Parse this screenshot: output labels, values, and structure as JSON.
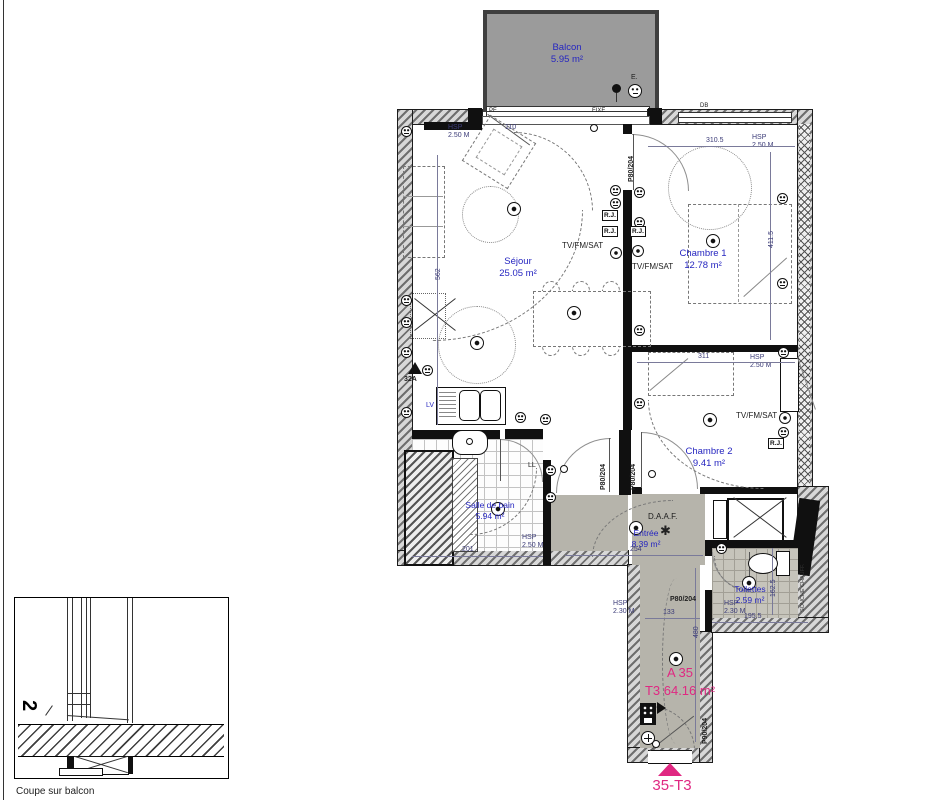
{
  "unit": {
    "code": "A 35",
    "type_area": "T3 64.16 m²",
    "entry_tag": "35-T3"
  },
  "balcony": {
    "name": "Balcon",
    "area": "5.95 m²"
  },
  "rooms": {
    "sejour": {
      "name": "Séjour",
      "area": "25.05 m²"
    },
    "chambre1": {
      "name": "Chambre 1",
      "area": "12.78 m²"
    },
    "chambre2": {
      "name": "Chambre 2",
      "area": "9.41 m²"
    },
    "sdb": {
      "name": "Salle de bain",
      "area": "5.94 m²"
    },
    "entree": {
      "name": "Entrée",
      "area": "8.39 m²"
    },
    "wc": {
      "name": "Toilettes",
      "area": "2.59 m²"
    }
  },
  "heights": {
    "hsp": "HSP",
    "h250": "2.50 M",
    "h230": "2.30 M"
  },
  "dims": {
    "d3105": "310.5",
    "d4115": "411.5",
    "d311": "311",
    "d562": "562",
    "d254": "254",
    "d133": "133",
    "d480": "480",
    "d1955": "195.5",
    "d1625": "162.5",
    "d201": "201",
    "d110": "110"
  },
  "doors": {
    "p80": "P80/204",
    "p90": "P90/204"
  },
  "windows": {
    "pf": "PF",
    "fixe": "FIXE",
    "db": "DB"
  },
  "electric": {
    "tv": "TV/FM/SAT",
    "rj": "R.J.",
    "daaf": "D.A.A.F.",
    "lv": "LV",
    "ll": "LL",
    "amp": "32A",
    "e": "E."
  },
  "shaft": {
    "line1": "SOUCHE",
    "line2": "CHAUFF."
  },
  "section": {
    "caption": "Coupe sur balcon",
    "level": "2"
  },
  "colors": {
    "pink": "#e02882",
    "room_label": "#2626c0",
    "dim_label": "#3c3c78"
  }
}
